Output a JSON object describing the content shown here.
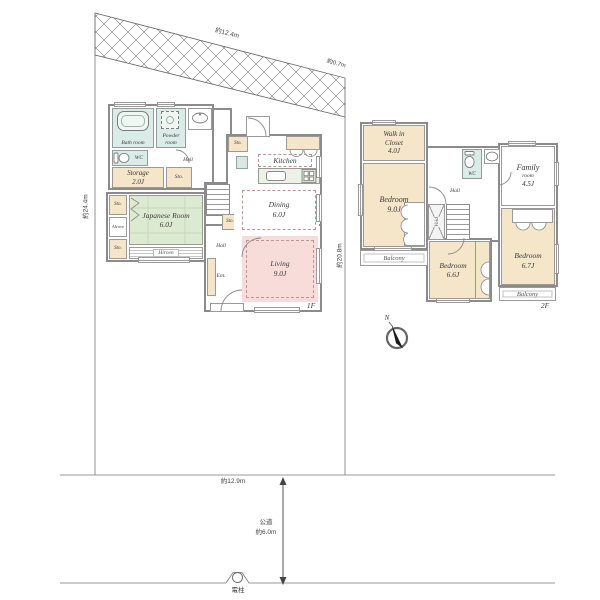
{
  "site": {
    "dim_top": "約12.4m",
    "dim_top_right": "約0.7m",
    "dim_left": "約24.4m",
    "dim_right": "約20.8m",
    "dim_bottom": "約12.9m",
    "road_name": "公道",
    "road_width": "約6.0m",
    "utility_pole": "電柱",
    "north_label": "N"
  },
  "floor1": {
    "label": "1F",
    "bath_name": "Bath room",
    "powder_name": "Powder room",
    "wc": "WC",
    "storage_name": "Storage",
    "storage_size": "2.0J",
    "japanese_name": "Japanese Room",
    "japanese_size": "6.0J",
    "alcove": "Alcove",
    "hiroen": "Hiroen",
    "sto": "Sto.",
    "hall": "Hall",
    "kitchen_name": "Kitchen",
    "dining_name": "Dining",
    "dining_size": "6.0J",
    "living_name": "Living",
    "living_size": "9.0J",
    "entrance": "Ent."
  },
  "floor2": {
    "label": "2F",
    "wic_name": "Walk in Closet",
    "wic_size": "4.0J",
    "bedroom_main_name": "Bedroom",
    "bedroom_main_size": "9.0J",
    "bedroom_b_name": "Bedroom",
    "bedroom_b_size": "6.6J",
    "bedroom_c_name": "Bedroom",
    "bedroom_c_size": "6.7J",
    "family_name": "Family",
    "family_name2": "room",
    "family_size": "4.5J",
    "wc": "WC",
    "hall": "Hall",
    "void": "Void",
    "balcony": "Balcony"
  }
}
